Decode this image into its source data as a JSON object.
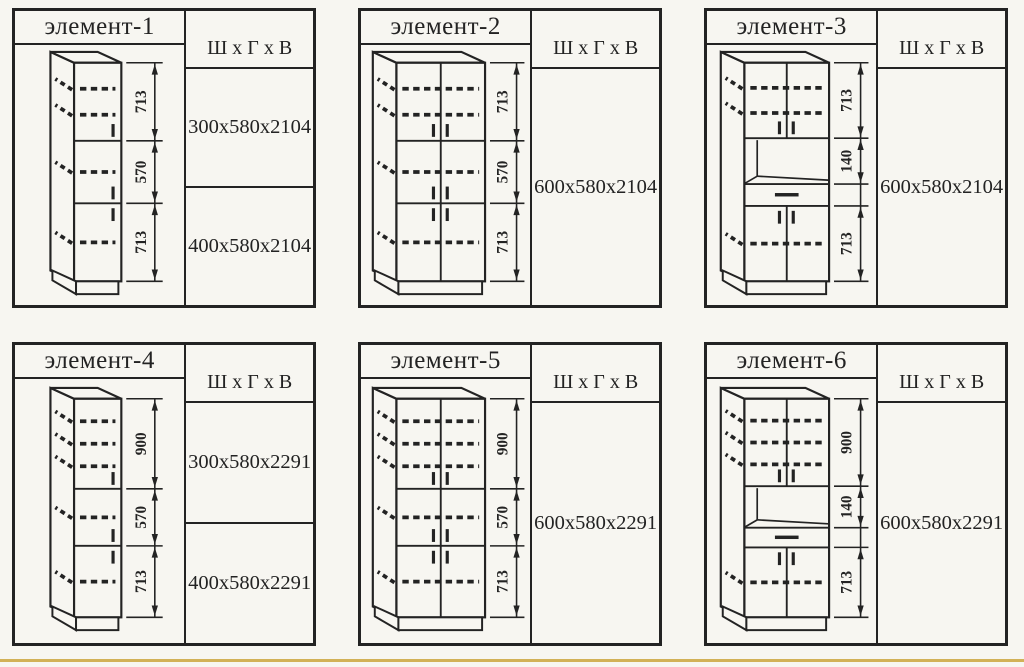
{
  "page": {
    "background": "#f7f6f1",
    "ink": "#232323",
    "accent_line_color": "#d2b157"
  },
  "panels": [
    {
      "title": "элемент-1",
      "header": "Ш x Г x В",
      "sizes": [
        "300x580x2104",
        "400x580x2104"
      ],
      "cabinet": {
        "style": "single",
        "segments": [
          {
            "label": "713",
            "frac": 0.357,
            "dashes": 2,
            "kind": "door"
          },
          {
            "label": "570",
            "frac": 0.286,
            "dashes": 1,
            "kind": "door"
          },
          {
            "label": "713",
            "frac": 0.357,
            "dashes": 1,
            "kind": "door"
          }
        ]
      }
    },
    {
      "title": "элемент-2",
      "header": "Ш x Г x В",
      "sizes": [
        "600x580x2104"
      ],
      "cabinet": {
        "style": "double",
        "segments": [
          {
            "label": "713",
            "frac": 0.357,
            "dashes": 2,
            "kind": "door"
          },
          {
            "label": "570",
            "frac": 0.286,
            "dashes": 1,
            "kind": "door"
          },
          {
            "label": "713",
            "frac": 0.357,
            "dashes": 1,
            "kind": "door"
          }
        ]
      }
    },
    {
      "title": "элемент-3",
      "header": "Ш x Г x В",
      "sizes": [
        "600x580x2104"
      ],
      "cabinet": {
        "style": "oven",
        "segments": [
          {
            "label": "713",
            "frac": 0.345,
            "dashes": 2,
            "kind": "door"
          },
          {
            "label": "140",
            "frac": 0.21,
            "dashes": 0,
            "kind": "niche"
          },
          {
            "frac": 0.1,
            "dashes": 0,
            "kind": "drawer"
          },
          {
            "label": "713",
            "frac": 0.345,
            "dashes": 1,
            "kind": "door"
          }
        ]
      }
    },
    {
      "title": "элемент-4",
      "header": "Ш x Г x В",
      "sizes": [
        "300x580x2291",
        "400x580x2291"
      ],
      "cabinet": {
        "style": "single",
        "segments": [
          {
            "label": "900",
            "frac": 0.412,
            "dashes": 3,
            "kind": "door"
          },
          {
            "label": "570",
            "frac": 0.261,
            "dashes": 1,
            "kind": "door"
          },
          {
            "label": "713",
            "frac": 0.327,
            "dashes": 1,
            "kind": "door"
          }
        ]
      }
    },
    {
      "title": "элемент-5",
      "header": "Ш x Г x В",
      "sizes": [
        "600x580x2291"
      ],
      "cabinet": {
        "style": "double",
        "segments": [
          {
            "label": "900",
            "frac": 0.412,
            "dashes": 3,
            "kind": "door"
          },
          {
            "label": "570",
            "frac": 0.261,
            "dashes": 1,
            "kind": "door"
          },
          {
            "label": "713",
            "frac": 0.327,
            "dashes": 1,
            "kind": "door"
          }
        ]
      }
    },
    {
      "title": "элемент-6",
      "header": "Ш x Г x В",
      "sizes": [
        "600x580x2291"
      ],
      "cabinet": {
        "style": "oven",
        "segments": [
          {
            "label": "900",
            "frac": 0.4,
            "dashes": 3,
            "kind": "door"
          },
          {
            "label": "140",
            "frac": 0.19,
            "dashes": 0,
            "kind": "niche"
          },
          {
            "frac": 0.09,
            "dashes": 0,
            "kind": "drawer"
          },
          {
            "label": "713",
            "frac": 0.32,
            "dashes": 1,
            "kind": "door"
          }
        ]
      }
    }
  ]
}
